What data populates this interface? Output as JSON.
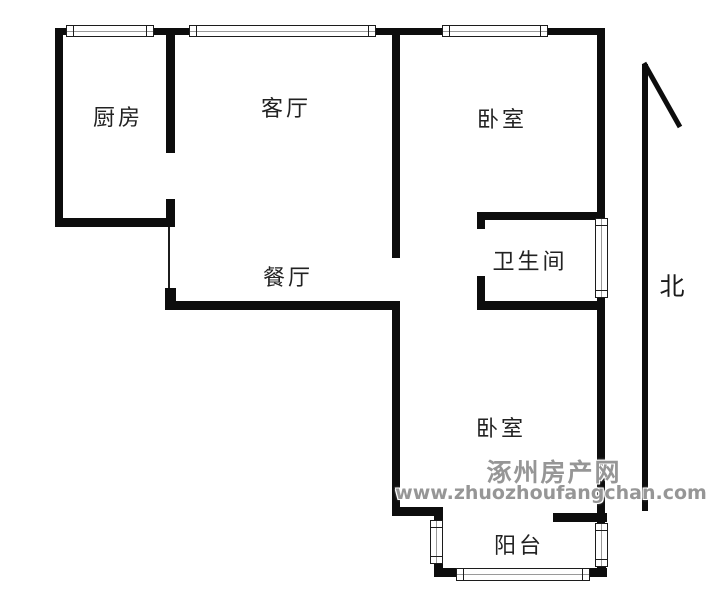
{
  "floor_plan": {
    "rooms": [
      {
        "id": "kitchen",
        "label": "厨房"
      },
      {
        "id": "living-room",
        "label": "客厅"
      },
      {
        "id": "bedroom-north",
        "label": "卧室"
      },
      {
        "id": "bathroom",
        "label": "卫生间"
      },
      {
        "id": "dining-room",
        "label": "餐厅"
      },
      {
        "id": "bedroom-south",
        "label": "卧室"
      },
      {
        "id": "balcony",
        "label": "阳台"
      }
    ],
    "compass": {
      "label": "北"
    }
  },
  "watermark": {
    "site_name": "涿州房产网",
    "site_url": "www.zhuozhoufangchan.com"
  },
  "colors": {
    "wall": "#0d0d0d",
    "room_label": "#222222",
    "watermark_text": "#969696",
    "background": "#ffffff"
  }
}
